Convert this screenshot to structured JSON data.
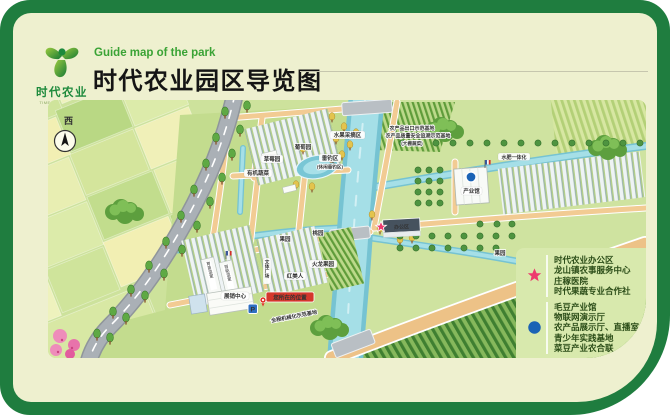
{
  "header": {
    "logo_cn": "时代农业",
    "logo_en": "TIME AGRICULTURE",
    "subtitle": "Guide map of the park",
    "title": "时代农业园区导览图"
  },
  "compass": {
    "label": "西"
  },
  "legend": {
    "star_items": [
      "时代农业办公区",
      "龙山镇农事服务中心",
      "庄稼医院",
      "时代果蔬专业合作社"
    ],
    "dot_items": [
      "毛豆产业馆",
      "物联网演示厅",
      "农产品展示厅、直播室",
      "青少年实践基地",
      "菜豆产业农合联"
    ]
  },
  "map_labels": {
    "picking": "水果采摘区",
    "grape": "葡萄园",
    "strawberry": "草莓园",
    "veg": "有机蔬菜",
    "fishing": "垂钓区",
    "fishing_sub": "(休闲垂钓区)",
    "cert1": "农产品出口示范基地",
    "cert2": "农产品质量安全追溯示范基地",
    "cert3": "(大棚蔬菜)",
    "fert": "水肥一体化",
    "hall": "产业馆",
    "office": "办公区",
    "orchard_l": "果园",
    "peach": "桃园",
    "dragon": "火龙果园",
    "redlady": "红美人",
    "plaza": "文体广场",
    "nursery": "育苗温室",
    "smart": "智能温室",
    "center": "展销中心",
    "youarehere": "您所在的位置",
    "parking": "P",
    "mech": "全程机械化示范基地",
    "orchard_r": "果园"
  },
  "colors": {
    "frame": "#1f7d3f",
    "panel": "#eef0cf",
    "accent_green": "#3aa335",
    "star_marker": "#ee3a6e",
    "dot_marker": "#1b63b5",
    "river": "#8fd0dd"
  }
}
